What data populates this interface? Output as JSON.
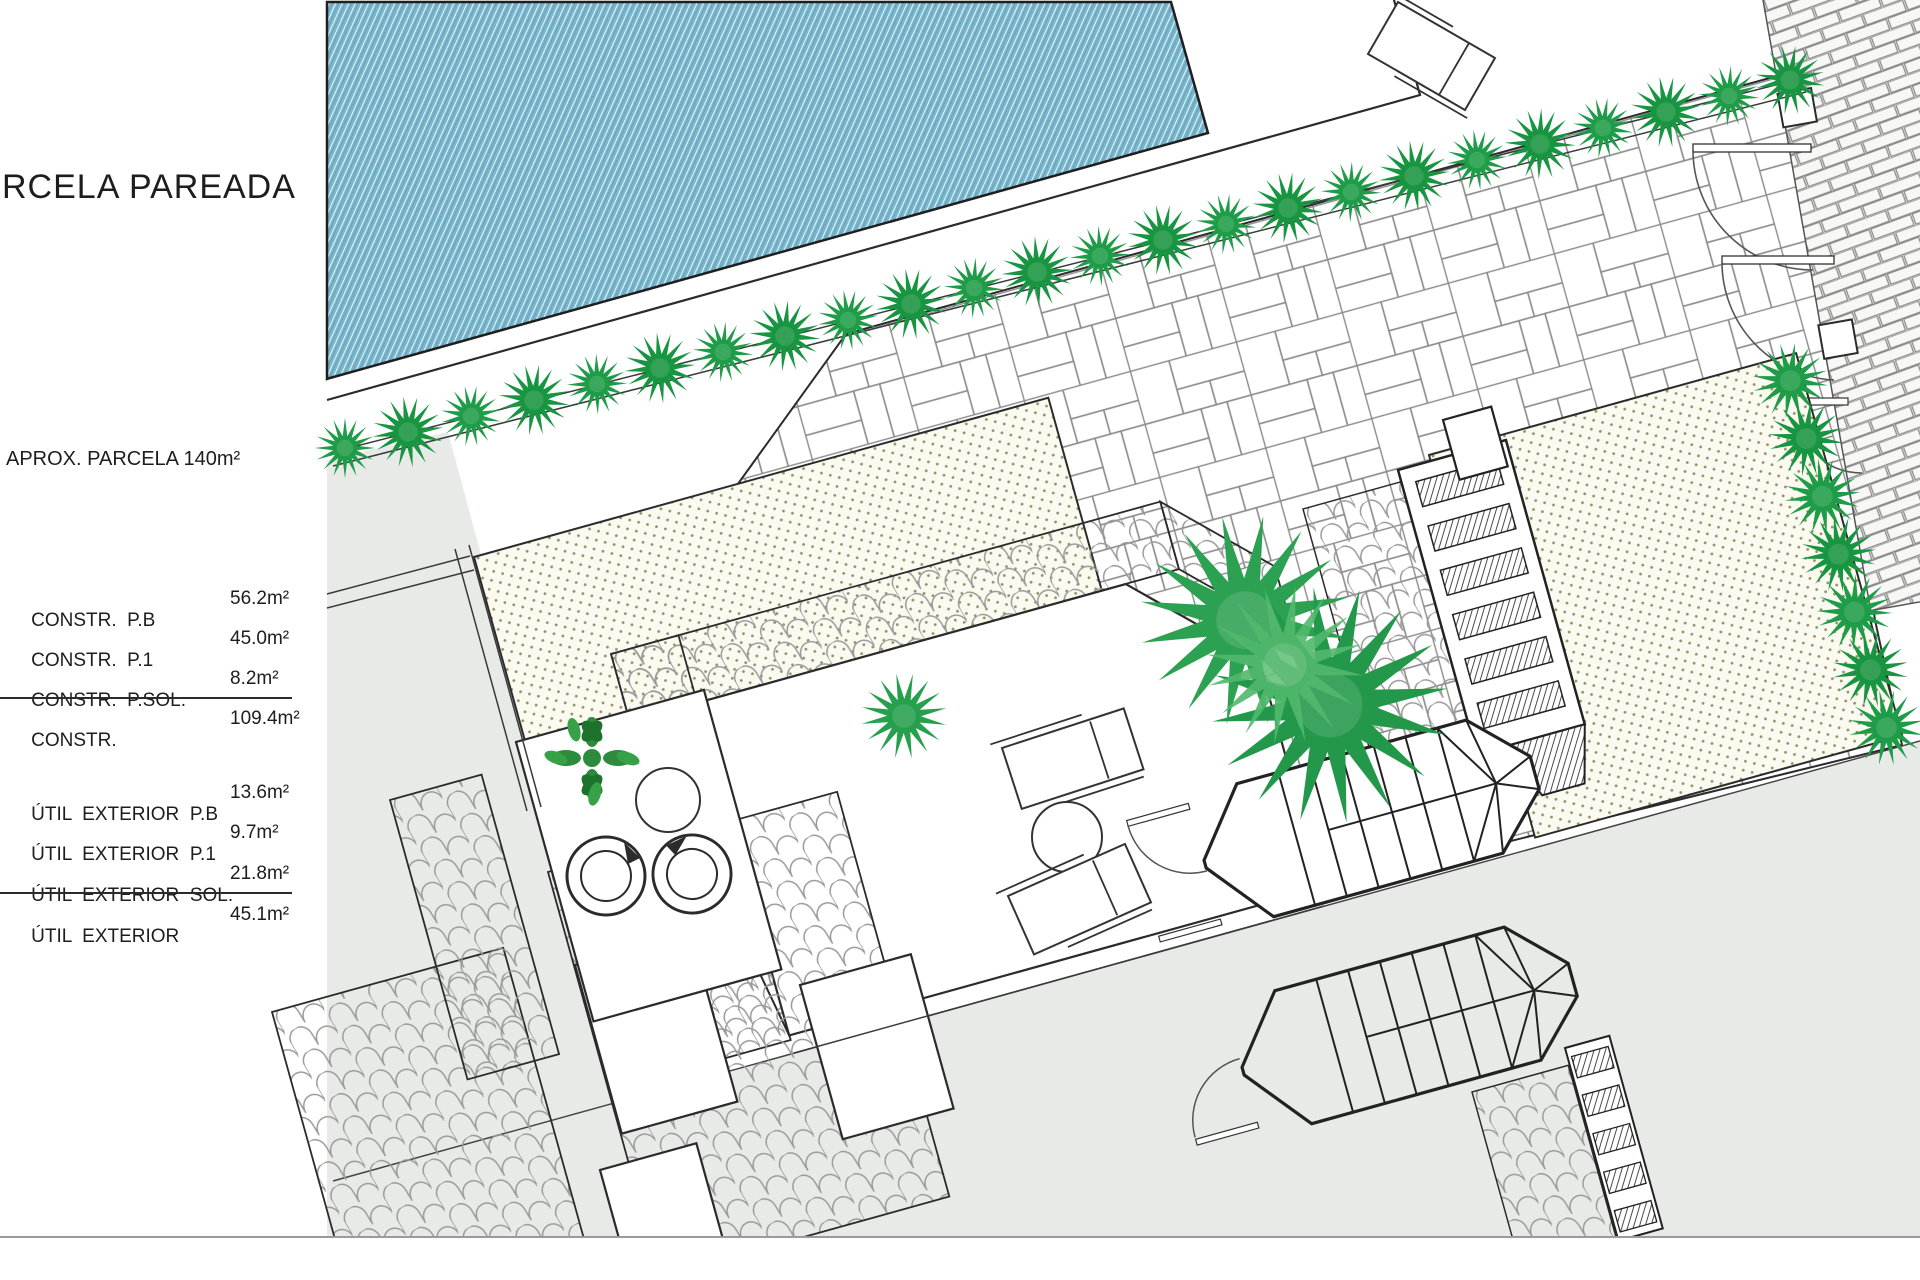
{
  "panel": {
    "title": "RCELA PAREADA",
    "parcel_note": "APROX. PARCELA 140m²",
    "constr_table": {
      "rows": [
        {
          "label": "CONSTR.  P.B",
          "value": "56.2m²"
        },
        {
          "label": "CONSTR.  P.1",
          "value": "45.0m²"
        },
        {
          "label": "CONSTR.  P.SOL.",
          "value": "8.2m²"
        }
      ],
      "total": {
        "label": "CONSTR.",
        "value": "109.4m²"
      }
    },
    "util_table": {
      "rows": [
        {
          "label": "ÚTIL  EXTERIOR  P.B",
          "value": "13.6m²"
        },
        {
          "label": "ÚTIL  EXTERIOR  P.1",
          "value": "9.7m²"
        },
        {
          "label": "ÚTIL  EXTERIOR  SOL.",
          "value": "21.8m²"
        }
      ],
      "total": {
        "label": "ÚTIL  EXTERIOR",
        "value": "45.1m²"
      }
    }
  },
  "plan": {
    "rotation_deg": -15.5,
    "colors": {
      "pool_water": "#79b5cb",
      "pool_hatch_light": "#e8f4f8",
      "hedge_green": "#1f9c47",
      "hedge_green_dark": "#189540",
      "palm_green": "#2da152",
      "palm_green_light": "#52b96d",
      "leaf_tree_green": "#2c8c3c",
      "stipple_dot": "#958f63",
      "stipple_bg": "#fbfaf0",
      "neighbor_gray": "#e8eae8",
      "line_dark": "#2b2b2b",
      "pattern_gray": "#8b8b8b"
    },
    "features": [
      "swimming-pool",
      "pool-deck",
      "hedge-row",
      "flagstone-patio",
      "boundary-brick-wall",
      "door-swings",
      "stippled-garden",
      "roof-tile-band",
      "terrace",
      "sun-loungers",
      "round-table",
      "egg-chairs",
      "leafy-tree",
      "fan-palms",
      "octagonal-stairs",
      "stair-pergola",
      "cobble-paths",
      "neighbor-parcel-gray"
    ]
  }
}
